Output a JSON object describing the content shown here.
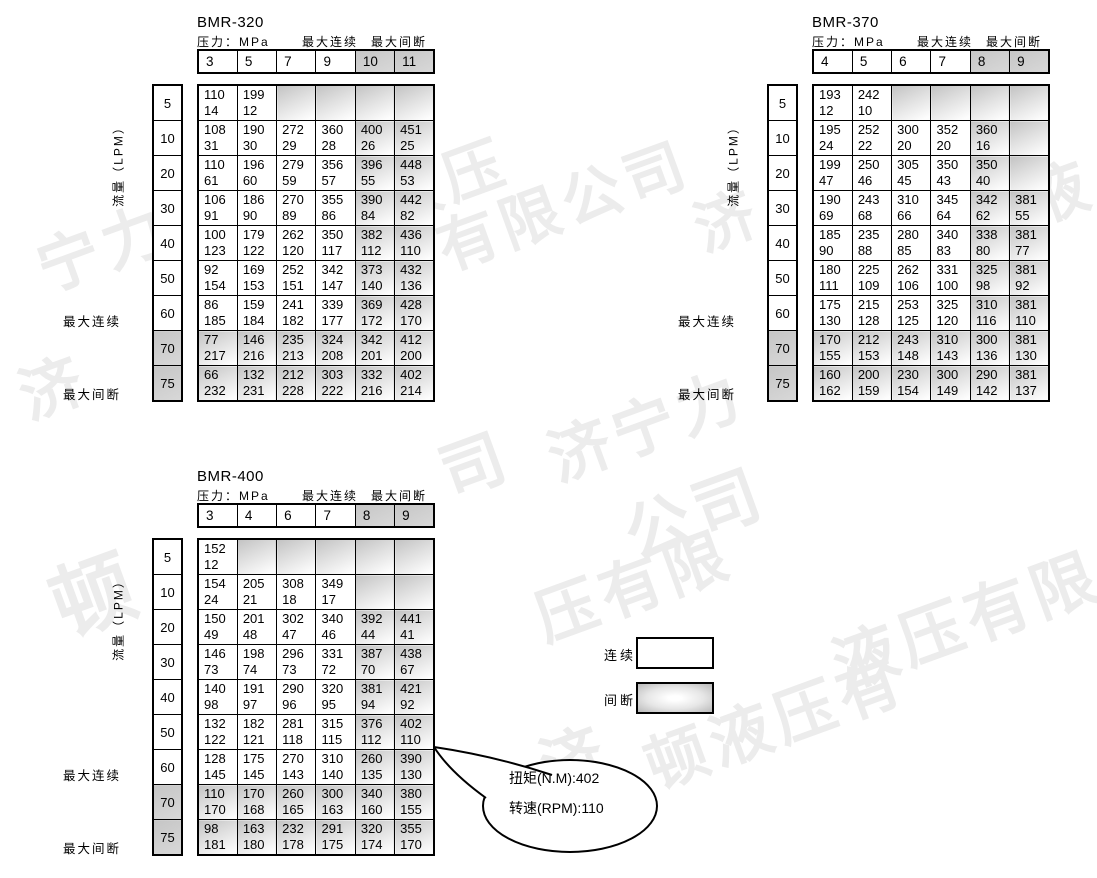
{
  "watermark": {
    "company": "济宁力顿液压有限公司",
    "fragments": [
      {
        "text": "宁力",
        "left": 40,
        "top": 272,
        "size": 62
      },
      {
        "text": "济",
        "left": 22,
        "top": 400,
        "size": 62
      },
      {
        "text": "液压",
        "left": 383,
        "top": 205,
        "size": 60
      },
      {
        "text": "有限公司",
        "left": 440,
        "top": 252,
        "size": 60
      },
      {
        "text": "济",
        "left": 697,
        "top": 233,
        "size": 60
      },
      {
        "text": "液",
        "left": 1028,
        "top": 205,
        "size": 62
      },
      {
        "text": "司",
        "left": 443,
        "top": 478,
        "size": 64
      },
      {
        "text": "济宁力",
        "left": 551,
        "top": 462,
        "size": 62
      },
      {
        "text": "顿",
        "left": 55,
        "top": 612,
        "size": 82
      },
      {
        "text": "公司",
        "left": 628,
        "top": 540,
        "size": 66
      },
      {
        "text": "压有限",
        "left": 538,
        "top": 622,
        "size": 62
      },
      {
        "text": "液压有限",
        "left": 836,
        "top": 670,
        "size": 64
      },
      {
        "text": "济",
        "left": 543,
        "top": 770,
        "size": 62
      },
      {
        "text": "顿液压有",
        "left": 648,
        "top": 770,
        "size": 62
      }
    ]
  },
  "legend": {
    "continuous_label": "连续",
    "intermittent_label": "间断"
  },
  "callout": {
    "line1": "扭矩(N.M):402",
    "line2": "转速(RPM):110"
  },
  "tables": [
    {
      "title": "BMR-320",
      "pressure_label": "压力：MPa",
      "max_continuous_label": "最大连续",
      "max_intermittent_label": "最大间断",
      "flow_label": "流量（LPM）",
      "columns": [
        "3",
        "5",
        "7",
        "9",
        "10",
        "11"
      ],
      "shaded_columns": [
        4,
        5
      ],
      "shaded_rows": [
        "70",
        "75"
      ],
      "rows": [
        {
          "flow": "5",
          "cells": [
            [
              "110",
              "14"
            ],
            [
              "199",
              "12"
            ],
            null,
            null,
            null,
            null
          ]
        },
        {
          "flow": "10",
          "cells": [
            [
              "108",
              "31"
            ],
            [
              "190",
              "30"
            ],
            [
              "272",
              "29"
            ],
            [
              "360",
              "28"
            ],
            [
              "400",
              "26"
            ],
            [
              "451",
              "25"
            ]
          ]
        },
        {
          "flow": "20",
          "cells": [
            [
              "110",
              "61"
            ],
            [
              "196",
              "60"
            ],
            [
              "279",
              "59"
            ],
            [
              "356",
              "57"
            ],
            [
              "396",
              "55"
            ],
            [
              "448",
              "53"
            ]
          ]
        },
        {
          "flow": "30",
          "cells": [
            [
              "106",
              "91"
            ],
            [
              "186",
              "90"
            ],
            [
              "270",
              "89"
            ],
            [
              "355",
              "86"
            ],
            [
              "390",
              "84"
            ],
            [
              "442",
              "82"
            ]
          ]
        },
        {
          "flow": "40",
          "cells": [
            [
              "100",
              "123"
            ],
            [
              "179",
              "122"
            ],
            [
              "262",
              "120"
            ],
            [
              "350",
              "117"
            ],
            [
              "382",
              "112"
            ],
            [
              "436",
              "110"
            ]
          ]
        },
        {
          "flow": "50",
          "cells": [
            [
              "92",
              "154"
            ],
            [
              "169",
              "153"
            ],
            [
              "252",
              "151"
            ],
            [
              "342",
              "147"
            ],
            [
              "373",
              "140"
            ],
            [
              "432",
              "136"
            ]
          ]
        },
        {
          "flow": "60",
          "cells": [
            [
              "86",
              "185"
            ],
            [
              "159",
              "184"
            ],
            [
              "241",
              "182"
            ],
            [
              "339",
              "177"
            ],
            [
              "369",
              "172"
            ],
            [
              "428",
              "170"
            ]
          ]
        },
        {
          "flow": "70",
          "cells": [
            [
              "77",
              "217"
            ],
            [
              "146",
              "216"
            ],
            [
              "235",
              "213"
            ],
            [
              "324",
              "208"
            ],
            [
              "342",
              "201"
            ],
            [
              "412",
              "200"
            ]
          ]
        },
        {
          "flow": "75",
          "cells": [
            [
              "66",
              "232"
            ],
            [
              "132",
              "231"
            ],
            [
              "212",
              "228"
            ],
            [
              "303",
              "222"
            ],
            [
              "332",
              "216"
            ],
            [
              "402",
              "214"
            ]
          ]
        }
      ]
    },
    {
      "title": "BMR-370",
      "pressure_label": "压力：MPa",
      "max_continuous_label": "最大连续",
      "max_intermittent_label": "最大间断",
      "flow_label": "流量（LPM）",
      "columns": [
        "4",
        "5",
        "6",
        "7",
        "8",
        "9"
      ],
      "shaded_columns": [
        4,
        5
      ],
      "shaded_rows": [
        "70",
        "75"
      ],
      "rows": [
        {
          "flow": "5",
          "cells": [
            [
              "193",
              "12"
            ],
            [
              "242",
              "10"
            ],
            null,
            null,
            null,
            null
          ]
        },
        {
          "flow": "10",
          "cells": [
            [
              "195",
              "24"
            ],
            [
              "252",
              "22"
            ],
            [
              "300",
              "20"
            ],
            [
              "352",
              "20"
            ],
            [
              "360",
              "16"
            ],
            null
          ]
        },
        {
          "flow": "20",
          "cells": [
            [
              "199",
              "47"
            ],
            [
              "250",
              "46"
            ],
            [
              "305",
              "45"
            ],
            [
              "350",
              "43"
            ],
            [
              "350",
              "40"
            ],
            null
          ]
        },
        {
          "flow": "30",
          "cells": [
            [
              "190",
              "69"
            ],
            [
              "243",
              "68"
            ],
            [
              "310",
              "66"
            ],
            [
              "345",
              "64"
            ],
            [
              "342",
              "62"
            ],
            [
              "381",
              "55"
            ]
          ]
        },
        {
          "flow": "40",
          "cells": [
            [
              "185",
              "90"
            ],
            [
              "235",
              "88"
            ],
            [
              "280",
              "85"
            ],
            [
              "340",
              "83"
            ],
            [
              "338",
              "80"
            ],
            [
              "381",
              "77"
            ]
          ]
        },
        {
          "flow": "50",
          "cells": [
            [
              "180",
              "111"
            ],
            [
              "225",
              "109"
            ],
            [
              "262",
              "106"
            ],
            [
              "331",
              "100"
            ],
            [
              "325",
              "98"
            ],
            [
              "381",
              "92"
            ]
          ]
        },
        {
          "flow": "60",
          "cells": [
            [
              "175",
              "130"
            ],
            [
              "215",
              "128"
            ],
            [
              "253",
              "125"
            ],
            [
              "325",
              "120"
            ],
            [
              "310",
              "116"
            ],
            [
              "381",
              "110"
            ]
          ]
        },
        {
          "flow": "70",
          "cells": [
            [
              "170",
              "155"
            ],
            [
              "212",
              "153"
            ],
            [
              "243",
              "148"
            ],
            [
              "310",
              "143"
            ],
            [
              "300",
              "136"
            ],
            [
              "381",
              "130"
            ]
          ]
        },
        {
          "flow": "75",
          "cells": [
            [
              "160",
              "162"
            ],
            [
              "200",
              "159"
            ],
            [
              "230",
              "154"
            ],
            [
              "300",
              "149"
            ],
            [
              "290",
              "142"
            ],
            [
              "381",
              "137"
            ]
          ]
        }
      ]
    },
    {
      "title": "BMR-400",
      "pressure_label": "压力：MPa",
      "max_continuous_label": "最大连续",
      "max_intermittent_label": "最大间断",
      "flow_label": "流量（LPM）",
      "columns": [
        "3",
        "4",
        "6",
        "7",
        "8",
        "9"
      ],
      "shaded_columns": [
        4,
        5
      ],
      "shaded_rows": [
        "70",
        "75"
      ],
      "rows": [
        {
          "flow": "5",
          "cells": [
            [
              "152",
              "12"
            ],
            null,
            null,
            null,
            null,
            null
          ]
        },
        {
          "flow": "10",
          "cells": [
            [
              "154",
              "24"
            ],
            [
              "205",
              "21"
            ],
            [
              "308",
              "18"
            ],
            [
              "349",
              "17"
            ],
            null,
            null
          ]
        },
        {
          "flow": "20",
          "cells": [
            [
              "150",
              "49"
            ],
            [
              "201",
              "48"
            ],
            [
              "302",
              "47"
            ],
            [
              "340",
              "46"
            ],
            [
              "392",
              "44"
            ],
            [
              "441",
              "41"
            ]
          ]
        },
        {
          "flow": "30",
          "cells": [
            [
              "146",
              "73"
            ],
            [
              "198",
              "74"
            ],
            [
              "296",
              "73"
            ],
            [
              "331",
              "72"
            ],
            [
              "387",
              "70"
            ],
            [
              "438",
              "67"
            ]
          ]
        },
        {
          "flow": "40",
          "cells": [
            [
              "140",
              "98"
            ],
            [
              "191",
              "97"
            ],
            [
              "290",
              "96"
            ],
            [
              "320",
              "95"
            ],
            [
              "381",
              "94"
            ],
            [
              "421",
              "92"
            ]
          ]
        },
        {
          "flow": "50",
          "cells": [
            [
              "132",
              "122"
            ],
            [
              "182",
              "121"
            ],
            [
              "281",
              "118"
            ],
            [
              "315",
              "115"
            ],
            [
              "376",
              "112"
            ],
            [
              "402",
              "110"
            ]
          ]
        },
        {
          "flow": "60",
          "cells": [
            [
              "128",
              "145"
            ],
            [
              "175",
              "145"
            ],
            [
              "270",
              "143"
            ],
            [
              "310",
              "140"
            ],
            [
              "260",
              "135"
            ],
            [
              "390",
              "130"
            ]
          ]
        },
        {
          "flow": "70",
          "cells": [
            [
              "110",
              "170"
            ],
            [
              "170",
              "168"
            ],
            [
              "260",
              "165"
            ],
            [
              "300",
              "163"
            ],
            [
              "340",
              "160"
            ],
            [
              "380",
              "155"
            ]
          ]
        },
        {
          "flow": "75",
          "cells": [
            [
              "98",
              "181"
            ],
            [
              "163",
              "180"
            ],
            [
              "232",
              "178"
            ],
            [
              "291",
              "175"
            ],
            [
              "320",
              "174"
            ],
            [
              "355",
              "170"
            ]
          ]
        }
      ]
    }
  ]
}
